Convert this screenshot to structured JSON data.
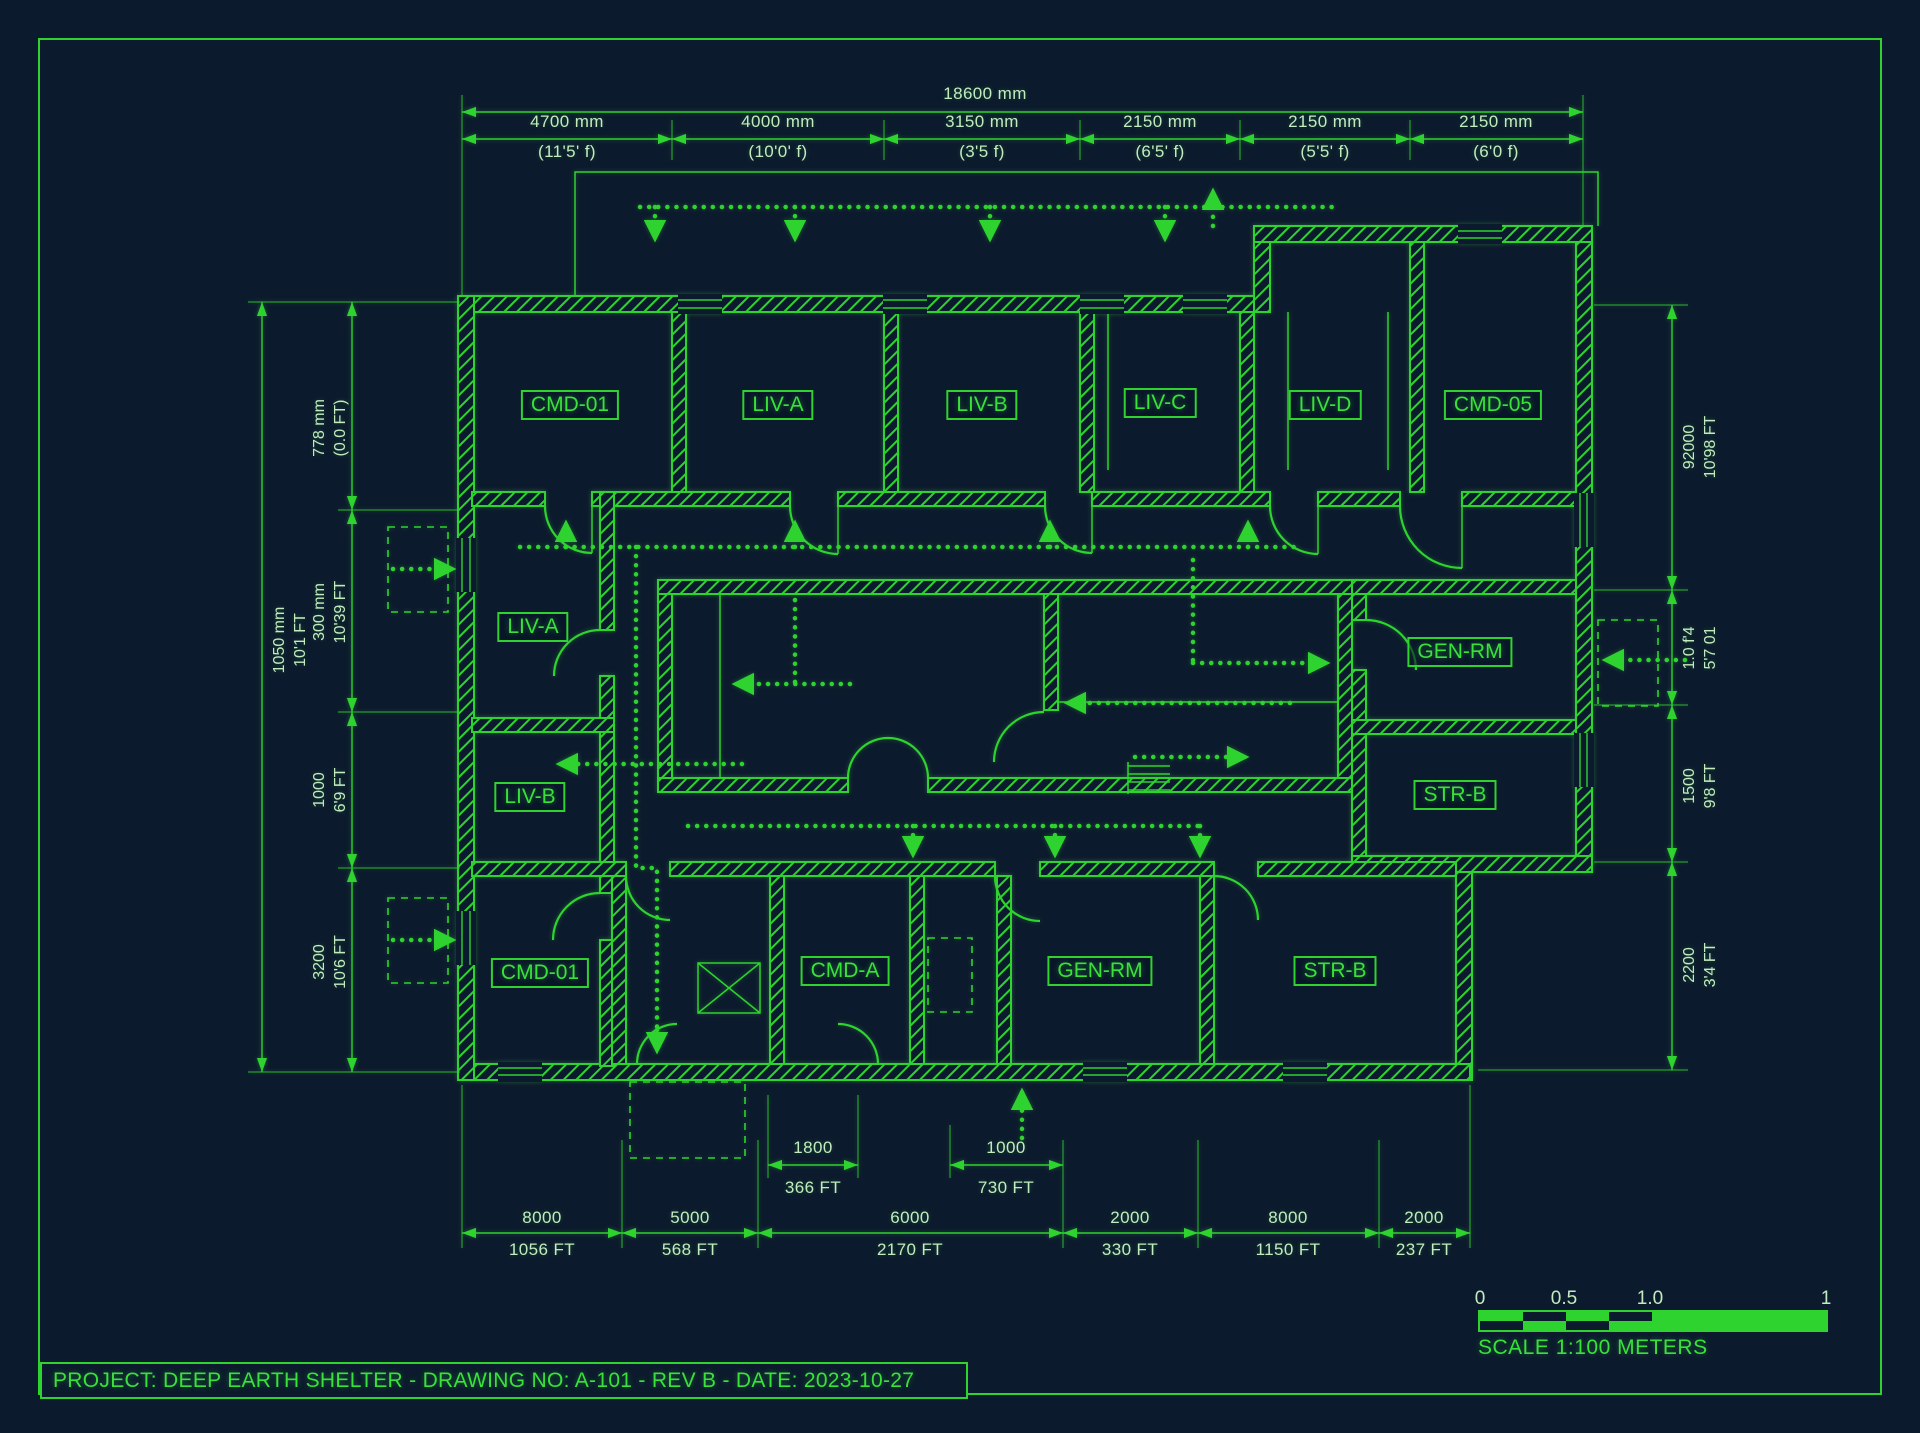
{
  "colors": {
    "background": "#0c1a2d",
    "line_green": "#2fd32f",
    "dim_text": "#c2ebbf",
    "label_green": "#3ae13a"
  },
  "title_block": {
    "text": "PROJECT: DEEP EARTH SHELTER - DRAWING NO: A-101 - REV B - DATE: 2023-10-27"
  },
  "scale_bar": {
    "tick0": "0",
    "tick1": "0.5",
    "tick2": "1.0",
    "tick3": "1",
    "caption": "SCALE 1:100 METERS"
  },
  "rooms": {
    "top": [
      "CMD-01",
      "LIV-A",
      "LIV-B",
      "LIV-C",
      "LIV-D",
      "CMD-05"
    ],
    "mid_left": [
      "LIV-A",
      "LIV-B"
    ],
    "mid_right": [
      "GEN-RM",
      "STR-B"
    ],
    "bottom": [
      "CMD-01",
      "CMD-A",
      "GEN-RM",
      "STR-B"
    ]
  },
  "dims": {
    "top_overall": "18600 mm",
    "top": [
      {
        "mm": "4700 mm",
        "ft": "(11'5' f)"
      },
      {
        "mm": "4000 mm",
        "ft": "(10'0' f)"
      },
      {
        "mm": "3150 mm",
        "ft": "(3'5 f)"
      },
      {
        "mm": "2150 mm",
        "ft": "(6'5' f)"
      },
      {
        "mm": "2150 mm",
        "ft": "(5'5' f)"
      },
      {
        "mm": "2150 mm",
        "ft": "(6'0 f)"
      }
    ],
    "left_overall": {
      "mm": "1050 mm",
      "ft": "10'1 FT"
    },
    "left": [
      {
        "mm": "778 mm",
        "ft": "(0.0 FT)"
      },
      {
        "mm": "300 mm",
        "ft": "10'39 FT"
      },
      {
        "mm": "1000",
        "ft": "6'9 FT"
      },
      {
        "mm": "3200",
        "ft": "10'6 FT"
      }
    ],
    "right": [
      {
        "mm": "92000",
        "ft": "10'98 FT"
      },
      {
        "mm": "1.0 f'4",
        "ft": "5'7 01"
      },
      {
        "mm": "1500",
        "ft": "9'8 FT"
      },
      {
        "mm": "2200",
        "ft": "3'4 FT"
      }
    ],
    "bottom": [
      {
        "mm": "8000",
        "ft": "1056 FT"
      },
      {
        "mm": "5000",
        "ft": "568 FT"
      },
      {
        "mm": "6000",
        "ft": "2170 FT"
      },
      {
        "mm": "2000",
        "ft": "330 FT"
      },
      {
        "mm": "8000",
        "ft": "1150 FT"
      },
      {
        "mm": "2000",
        "ft": "237 FT"
      }
    ],
    "inner": [
      {
        "mm": "1800",
        "ft": "366 FT"
      },
      {
        "mm": "1000",
        "ft": "730 FT"
      }
    ]
  }
}
